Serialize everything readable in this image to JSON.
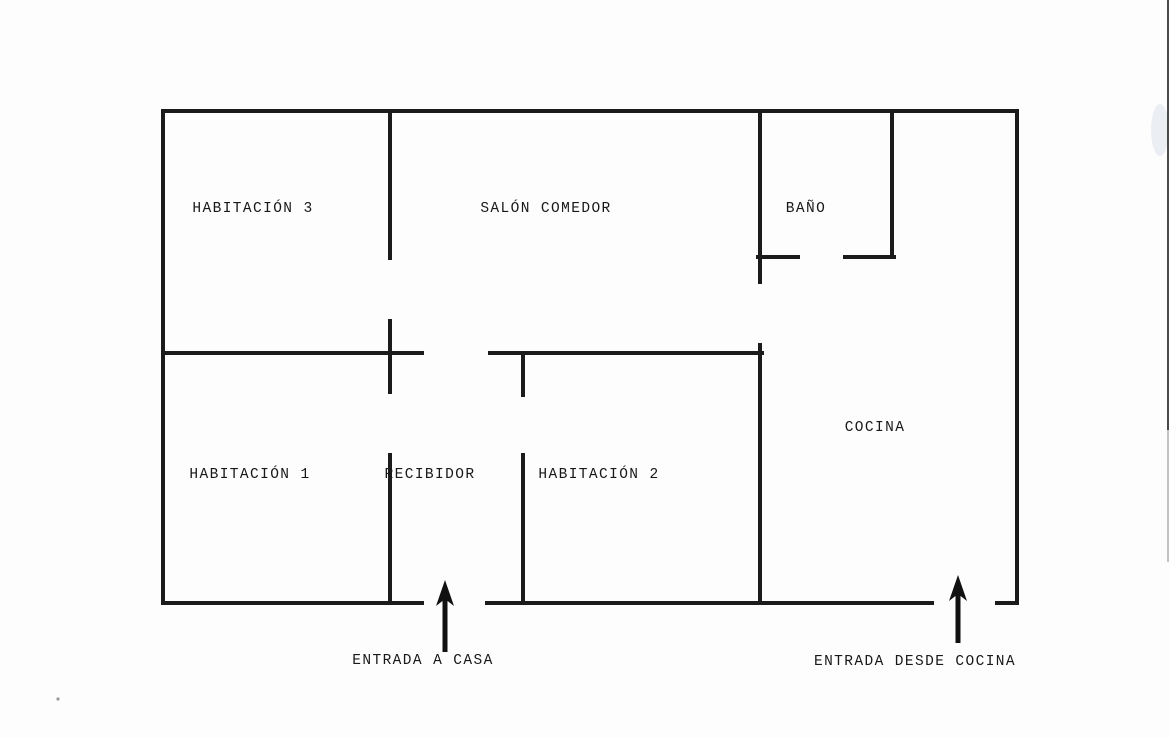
{
  "page": {
    "ink_color": "#1b1b1b",
    "paper_color": "#fdfdfd"
  },
  "floorplan": {
    "canvas": {
      "width": 1170,
      "height": 738
    },
    "rooms": [
      {
        "id": "habitacion-3",
        "label": "HABITACIÓN 3",
        "cx": 253,
        "cy": 207
      },
      {
        "id": "salon-comedor",
        "label": "SALÓN COMEDOR",
        "cx": 546,
        "cy": 207
      },
      {
        "id": "bano",
        "label": "BAÑO",
        "cx": 806,
        "cy": 207
      },
      {
        "id": "cocina",
        "label": "COCINA",
        "cx": 875,
        "cy": 426
      },
      {
        "id": "habitacion-1",
        "label": "HABITACIÓN 1",
        "cx": 250,
        "cy": 473
      },
      {
        "id": "recibidor",
        "label": "RECIBIDOR",
        "cx": 430,
        "cy": 473
      },
      {
        "id": "habitacion-2",
        "label": "HABITACIÓN 2",
        "cx": 599,
        "cy": 473
      }
    ],
    "walls": [
      {
        "x1": 163,
        "y1": 111,
        "x2": 1017,
        "y2": 111
      },
      {
        "x1": 163,
        "y1": 111,
        "x2": 163,
        "y2": 603
      },
      {
        "x1": 1017,
        "y1": 111,
        "x2": 1017,
        "y2": 603
      },
      {
        "x1": 163,
        "y1": 603,
        "x2": 422,
        "y2": 603
      },
      {
        "x1": 487,
        "y1": 603,
        "x2": 932,
        "y2": 603
      },
      {
        "x1": 997,
        "y1": 603,
        "x2": 1017,
        "y2": 603
      },
      {
        "x1": 163,
        "y1": 353,
        "x2": 422,
        "y2": 353
      },
      {
        "x1": 490,
        "y1": 353,
        "x2": 762,
        "y2": 353
      },
      {
        "x1": 390,
        "y1": 111,
        "x2": 390,
        "y2": 258
      },
      {
        "x1": 390,
        "y1": 321,
        "x2": 390,
        "y2": 392
      },
      {
        "x1": 390,
        "y1": 455,
        "x2": 390,
        "y2": 603
      },
      {
        "x1": 523,
        "y1": 353,
        "x2": 523,
        "y2": 395
      },
      {
        "x1": 523,
        "y1": 455,
        "x2": 523,
        "y2": 603
      },
      {
        "x1": 760,
        "y1": 111,
        "x2": 760,
        "y2": 282
      },
      {
        "x1": 760,
        "y1": 345,
        "x2": 760,
        "y2": 603
      },
      {
        "x1": 892,
        "y1": 111,
        "x2": 892,
        "y2": 257
      },
      {
        "x1": 758,
        "y1": 257,
        "x2": 798,
        "y2": 257
      },
      {
        "x1": 845,
        "y1": 257,
        "x2": 894,
        "y2": 257
      }
    ],
    "entrances": [
      {
        "id": "entrada-a-casa",
        "label": "ENTRADA A CASA",
        "arrow": {
          "x": 445,
          "tip_y": 580,
          "tail_y": 652,
          "head_w": 18,
          "head_h": 26
        },
        "label_cx": 423,
        "label_cy": 664
      },
      {
        "id": "entrada-desde-cocina",
        "label": "ENTRADA DESDE COCINA",
        "arrow": {
          "x": 958,
          "tip_y": 575,
          "tail_y": 643,
          "head_w": 18,
          "head_h": 26
        },
        "label_cx": 915,
        "label_cy": 665
      }
    ],
    "scan_artifacts": {
      "right_edge_line": {
        "x": 1168,
        "y_top": 0,
        "y_dark_end": 430,
        "y_fade_end": 562
      },
      "smudge": {
        "cx": 1160,
        "cy": 130,
        "rx": 9,
        "ry": 26
      },
      "dot": {
        "cx": 58,
        "cy": 699,
        "r": 1.6
      }
    }
  }
}
